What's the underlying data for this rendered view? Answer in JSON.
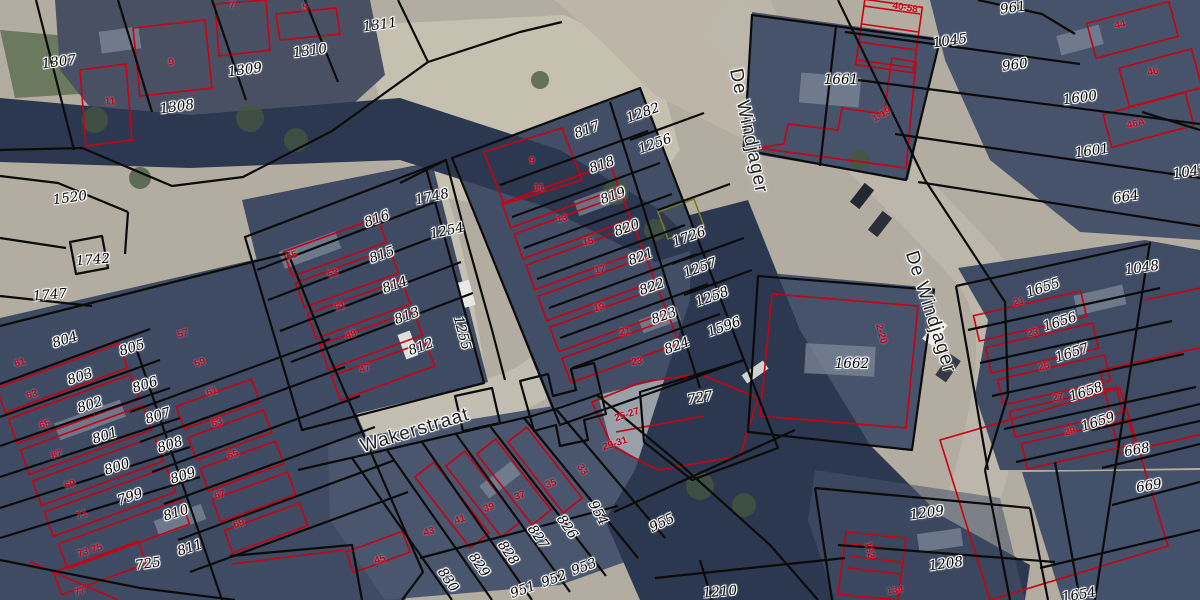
{
  "map": {
    "colors": {
      "parcel_boundary": "#0b0b0b",
      "building_outline": "#cc0011",
      "special_boundary_olive": "#767a2b",
      "parcel_label": "#000000",
      "label_halo": "#ffffff",
      "house_number": "#c40016",
      "street_label": "#222222"
    },
    "street_labels": [
      {
        "t": "Wakerstraat",
        "x": 415,
        "y": 431,
        "r": -17
      },
      {
        "t": "De Windjager",
        "x": 748,
        "y": 131,
        "r": 78
      },
      {
        "t": "De Windjager",
        "x": 930,
        "y": 312,
        "r": 72
      }
    ],
    "parcel_labels": [
      {
        "t": "1307",
        "x": 59,
        "y": 62,
        "r": -8
      },
      {
        "t": "1309",
        "x": 245,
        "y": 70,
        "r": -8
      },
      {
        "t": "1310",
        "x": 310,
        "y": 51,
        "r": -8
      },
      {
        "t": "1311",
        "x": 380,
        "y": 25,
        "r": -8
      },
      {
        "t": "1308",
        "x": 177,
        "y": 107,
        "r": -8
      },
      {
        "t": "1520",
        "x": 70,
        "y": 198,
        "r": -8
      },
      {
        "t": "1742",
        "x": 93,
        "y": 260,
        "r": -5
      },
      {
        "t": "1747",
        "x": 50,
        "y": 295,
        "r": -5
      },
      {
        "t": "1748",
        "x": 432,
        "y": 197,
        "r": -12
      },
      {
        "t": "816",
        "x": 377,
        "y": 219,
        "r": -20
      },
      {
        "t": "1254",
        "x": 447,
        "y": 231,
        "r": -12
      },
      {
        "t": "815",
        "x": 382,
        "y": 255,
        "r": -20
      },
      {
        "t": "814",
        "x": 395,
        "y": 285,
        "r": -20
      },
      {
        "t": "813",
        "x": 407,
        "y": 316,
        "r": -20
      },
      {
        "t": "812",
        "x": 421,
        "y": 347,
        "r": -20
      },
      {
        "t": "1255",
        "x": 462,
        "y": 333,
        "r": 75
      },
      {
        "t": "804",
        "x": 65,
        "y": 340,
        "r": -18
      },
      {
        "t": "805",
        "x": 132,
        "y": 348,
        "r": -18
      },
      {
        "t": "803",
        "x": 80,
        "y": 377,
        "r": -18
      },
      {
        "t": "806",
        "x": 145,
        "y": 385,
        "r": -18
      },
      {
        "t": "802",
        "x": 90,
        "y": 405,
        "r": -18
      },
      {
        "t": "807",
        "x": 158,
        "y": 416,
        "r": -18
      },
      {
        "t": "801",
        "x": 105,
        "y": 436,
        "r": -18
      },
      {
        "t": "808",
        "x": 170,
        "y": 445,
        "r": -18
      },
      {
        "t": "800",
        "x": 117,
        "y": 467,
        "r": -18
      },
      {
        "t": "809",
        "x": 183,
        "y": 476,
        "r": -18
      },
      {
        "t": "799",
        "x": 130,
        "y": 497,
        "r": -18
      },
      {
        "t": "810",
        "x": 176,
        "y": 513,
        "r": -18
      },
      {
        "t": "811",
        "x": 190,
        "y": 548,
        "r": -18
      },
      {
        "t": "725",
        "x": 148,
        "y": 564,
        "r": -8
      },
      {
        "t": "817",
        "x": 587,
        "y": 130,
        "r": -20
      },
      {
        "t": "818",
        "x": 602,
        "y": 165,
        "r": -20
      },
      {
        "t": "819",
        "x": 613,
        "y": 196,
        "r": -20
      },
      {
        "t": "820",
        "x": 627,
        "y": 228,
        "r": -20
      },
      {
        "t": "821",
        "x": 641,
        "y": 257,
        "r": -20
      },
      {
        "t": "822",
        "x": 652,
        "y": 287,
        "r": -20
      },
      {
        "t": "823",
        "x": 664,
        "y": 316,
        "r": -20
      },
      {
        "t": "824",
        "x": 677,
        "y": 346,
        "r": -20
      },
      {
        "t": "1282",
        "x": 643,
        "y": 113,
        "r": -20
      },
      {
        "t": "1256",
        "x": 655,
        "y": 144,
        "r": -20
      },
      {
        "t": "1726",
        "x": 689,
        "y": 237,
        "r": -20
      },
      {
        "t": "1257",
        "x": 700,
        "y": 268,
        "r": -20
      },
      {
        "t": "1258",
        "x": 712,
        "y": 297,
        "r": -20
      },
      {
        "t": "1596",
        "x": 724,
        "y": 327,
        "r": -20
      },
      {
        "t": "727",
        "x": 700,
        "y": 398,
        "r": -10
      },
      {
        "t": "961",
        "x": 1013,
        "y": 8,
        "r": -8
      },
      {
        "t": "1045",
        "x": 950,
        "y": 41,
        "r": -8
      },
      {
        "t": "960",
        "x": 1015,
        "y": 65,
        "r": -8
      },
      {
        "t": "1600",
        "x": 1080,
        "y": 98,
        "r": -8
      },
      {
        "t": "1601",
        "x": 1092,
        "y": 151,
        "r": -8
      },
      {
        "t": "664",
        "x": 1126,
        "y": 197,
        "r": -8
      },
      {
        "t": "1047",
        "x": 1190,
        "y": 172,
        "r": -8
      },
      {
        "t": "1661",
        "x": 841,
        "y": 80,
        "r": 0
      },
      {
        "t": "1662",
        "x": 852,
        "y": 364,
        "r": 0
      },
      {
        "t": "1048",
        "x": 1142,
        "y": 268,
        "r": -8
      },
      {
        "t": "1655",
        "x": 1043,
        "y": 288,
        "r": -18
      },
      {
        "t": "1656",
        "x": 1060,
        "y": 322,
        "r": -18
      },
      {
        "t": "1657",
        "x": 1072,
        "y": 353,
        "r": -18
      },
      {
        "t": "1658",
        "x": 1086,
        "y": 392,
        "r": -18
      },
      {
        "t": "1659",
        "x": 1098,
        "y": 422,
        "r": -18
      },
      {
        "t": "668",
        "x": 1137,
        "y": 450,
        "r": -10
      },
      {
        "t": "669",
        "x": 1149,
        "y": 486,
        "r": -10
      },
      {
        "t": "1209",
        "x": 927,
        "y": 513,
        "r": -8
      },
      {
        "t": "1208",
        "x": 946,
        "y": 564,
        "r": -8
      },
      {
        "t": "1210",
        "x": 720,
        "y": 592,
        "r": -5
      },
      {
        "t": "1654",
        "x": 1079,
        "y": 595,
        "r": -10
      },
      {
        "t": "955",
        "x": 662,
        "y": 523,
        "r": -25
      },
      {
        "t": "954",
        "x": 598,
        "y": 513,
        "r": 62
      },
      {
        "t": "953",
        "x": 584,
        "y": 567,
        "r": -20
      },
      {
        "t": "952",
        "x": 554,
        "y": 579,
        "r": -20
      },
      {
        "t": "951",
        "x": 523,
        "y": 590,
        "r": -20
      },
      {
        "t": "826",
        "x": 567,
        "y": 527,
        "r": 55
      },
      {
        "t": "827",
        "x": 538,
        "y": 537,
        "r": 55
      },
      {
        "t": "828",
        "x": 508,
        "y": 553,
        "r": 55
      },
      {
        "t": "829",
        "x": 479,
        "y": 565,
        "r": 55
      },
      {
        "t": "830",
        "x": 448,
        "y": 580,
        "r": 55
      }
    ],
    "house_number_labels": [
      {
        "t": "7",
        "x": 232,
        "y": 6,
        "r": 0
      },
      {
        "t": "5",
        "x": 305,
        "y": 8,
        "r": 0
      },
      {
        "t": "9",
        "x": 171,
        "y": 63,
        "r": 0
      },
      {
        "t": "11",
        "x": 110,
        "y": 102,
        "r": 0
      },
      {
        "t": "9",
        "x": 532,
        "y": 161,
        "r": 0
      },
      {
        "t": "11",
        "x": 539,
        "y": 188,
        "r": 0
      },
      {
        "t": "13",
        "x": 562,
        "y": 219,
        "r": -10
      },
      {
        "t": "15",
        "x": 588,
        "y": 242,
        "r": -10
      },
      {
        "t": "17",
        "x": 600,
        "y": 270,
        "r": -10
      },
      {
        "t": "19",
        "x": 599,
        "y": 308,
        "r": -10
      },
      {
        "t": "21",
        "x": 625,
        "y": 332,
        "r": -10
      },
      {
        "t": "23",
        "x": 637,
        "y": 362,
        "r": -10
      },
      {
        "t": "55",
        "x": 292,
        "y": 256,
        "r": -18
      },
      {
        "t": "53",
        "x": 333,
        "y": 274,
        "r": -18
      },
      {
        "t": "51",
        "x": 340,
        "y": 307,
        "r": -18
      },
      {
        "t": "49",
        "x": 351,
        "y": 335,
        "r": -18
      },
      {
        "t": "47",
        "x": 365,
        "y": 369,
        "r": -18
      },
      {
        "t": "57",
        "x": 183,
        "y": 334,
        "r": -18
      },
      {
        "t": "59",
        "x": 200,
        "y": 363,
        "r": -18
      },
      {
        "t": "61",
        "x": 20,
        "y": 363,
        "r": -18
      },
      {
        "t": "63",
        "x": 32,
        "y": 395,
        "r": -18
      },
      {
        "t": "65",
        "x": 45,
        "y": 425,
        "r": -18
      },
      {
        "t": "67",
        "x": 57,
        "y": 455,
        "r": -18
      },
      {
        "t": "69",
        "x": 70,
        "y": 485,
        "r": -18
      },
      {
        "t": "71",
        "x": 82,
        "y": 515,
        "r": -18
      },
      {
        "t": "73-75",
        "x": 90,
        "y": 551,
        "r": -18
      },
      {
        "t": "77",
        "x": 80,
        "y": 592,
        "r": -18
      },
      {
        "t": "61",
        "x": 212,
        "y": 392,
        "r": -18
      },
      {
        "t": "63",
        "x": 217,
        "y": 423,
        "r": -18
      },
      {
        "t": "65",
        "x": 233,
        "y": 455,
        "r": -18
      },
      {
        "t": "67",
        "x": 220,
        "y": 495,
        "r": -18
      },
      {
        "t": "69",
        "x": 239,
        "y": 524,
        "r": -18
      },
      {
        "t": "45",
        "x": 380,
        "y": 560,
        "r": -18
      },
      {
        "t": "43",
        "x": 429,
        "y": 532,
        "r": -18
      },
      {
        "t": "41",
        "x": 460,
        "y": 520,
        "r": -18
      },
      {
        "t": "39",
        "x": 489,
        "y": 508,
        "r": -18
      },
      {
        "t": "37",
        "x": 520,
        "y": 496,
        "r": -18
      },
      {
        "t": "35",
        "x": 551,
        "y": 484,
        "r": -18
      },
      {
        "t": "33",
        "x": 582,
        "y": 470,
        "r": 55
      },
      {
        "t": "29-31",
        "x": 615,
        "y": 444,
        "r": -18
      },
      {
        "t": "25-27",
        "x": 627,
        "y": 415,
        "r": -18
      },
      {
        "t": "44",
        "x": 1120,
        "y": 25,
        "r": -12
      },
      {
        "t": "46",
        "x": 1153,
        "y": 72,
        "r": -12
      },
      {
        "t": "46A",
        "x": 1136,
        "y": 124,
        "r": -12
      },
      {
        "t": "40-58",
        "x": 905,
        "y": 8,
        "r": 10
      },
      {
        "t": "1-19",
        "x": 882,
        "y": 115,
        "r": -30
      },
      {
        "t": "2-20",
        "x": 881,
        "y": 334,
        "r": 75
      },
      {
        "t": "21",
        "x": 1019,
        "y": 302,
        "r": -14
      },
      {
        "t": "23",
        "x": 1033,
        "y": 333,
        "r": -14
      },
      {
        "t": "25",
        "x": 1044,
        "y": 367,
        "r": -14
      },
      {
        "t": "27",
        "x": 1058,
        "y": 398,
        "r": -14
      },
      {
        "t": "29",
        "x": 1070,
        "y": 432,
        "r": -14
      },
      {
        "t": "132",
        "x": 869,
        "y": 550,
        "r": 75
      },
      {
        "t": "134",
        "x": 895,
        "y": 591,
        "r": -8
      }
    ]
  }
}
